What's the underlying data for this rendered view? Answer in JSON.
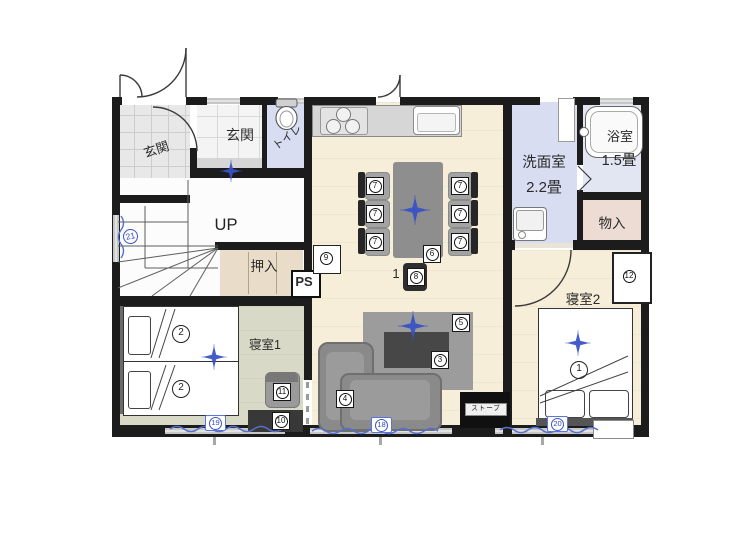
{
  "rooms": {
    "porch": "玄関",
    "hall": "玄関",
    "toilet": "トイレ",
    "washroom": "洗面室",
    "washroom_size": "2.2畳",
    "bathroom": "浴室",
    "bathroom_size": "1.5畳",
    "storage": "物入",
    "closet": "押入",
    "pipe_space": "PS",
    "stairs": "UP",
    "bedroom1": "寝室1",
    "bedroom2": "寝室2"
  },
  "labels": {
    "heater": "ストーブ",
    "dining_note": "1"
  },
  "markers": {
    "bed_bedroom2": "1",
    "bed_bedroom1": "2",
    "living_table": "3",
    "sofa": "4",
    "rug": "5",
    "dining_table": "6",
    "dining_chair": "7",
    "end_chair": "8",
    "kitchen_side": "9",
    "tv_board": "10",
    "side_cabinet": "11",
    "cabinet": "12",
    "window_living": "18",
    "window_bedroom1": "19",
    "window_bedroom2": "20",
    "window_stairs": "21"
  },
  "colors": {
    "wall": "#1c1c1c",
    "floor_wood": "#f6eed8",
    "floor_bedroom1": "#d9d9c8",
    "floor_wet": "#d8ddf1",
    "floor_bath": "#e1e6f2",
    "floor_storage": "#eddcd4",
    "floor_closet": "#e9dcc8",
    "accent_blue": "#3a55c8",
    "furniture_gray": "#8f8f8f"
  }
}
